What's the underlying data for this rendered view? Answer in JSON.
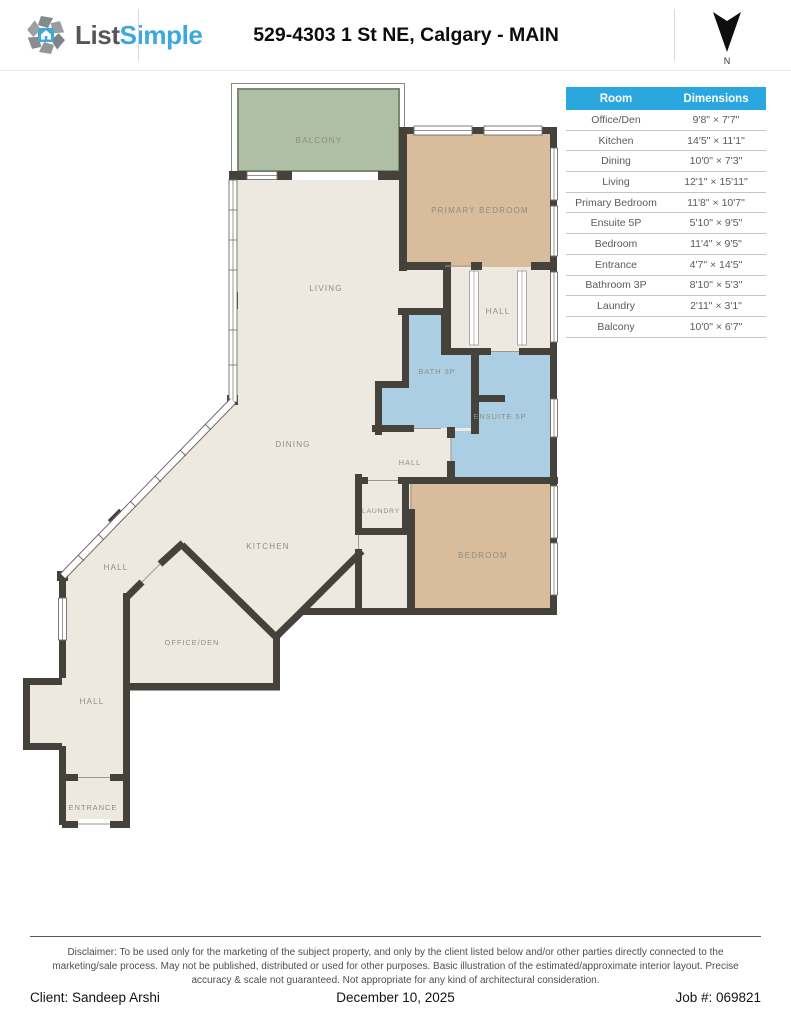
{
  "header": {
    "brand_list": "List",
    "brand_simple": "Simple",
    "title": "529-4303 1 St NE, Calgary - MAIN",
    "north_label": "N"
  },
  "colors": {
    "table_header": "#2aa7df",
    "brand_blue": "#3ba8de",
    "wall": "#45423c",
    "floor_cream": "#ede9e0",
    "room_tan": "#d8bc9b",
    "room_blue": "#abcee2",
    "balcony_green": "#aebfa6",
    "label_gray": "#8f8d85"
  },
  "table": {
    "columns": [
      "Room",
      "Dimensions"
    ],
    "rows": [
      [
        "Office/Den",
        "9'8\" × 7'7\""
      ],
      [
        "Kitchen",
        "14'5\" × 11'1\""
      ],
      [
        "Dining",
        "10'0\" × 7'3\""
      ],
      [
        "Living",
        "12'1\" × 15'11\""
      ],
      [
        "Primary Bedroom",
        "11'8\" × 10'7\""
      ],
      [
        "Ensuite 5P",
        "5'10\" × 9'5\""
      ],
      [
        "Bedroom",
        "11'4\" × 9'5\""
      ],
      [
        "Entrance",
        "4'7\" × 14'5\""
      ],
      [
        "Bathroom 3P",
        "8'10\" × 5'3\""
      ],
      [
        "Laundry",
        "2'11\" × 3'1\""
      ],
      [
        "Balcony",
        "10'0\" × 6'7\""
      ]
    ]
  },
  "plan": {
    "labels": {
      "balcony": "BALCONY",
      "primary_bedroom": "PRIMARY BEDROOM",
      "living": "LIVING",
      "hall_upper": "HALL",
      "bath": "BATH 3P",
      "ensuite": "ENSUITE 5P",
      "dining": "DINING",
      "hall_middle": "HALL",
      "laundry": "LAUNDRY",
      "kitchen": "KITCHEN",
      "bedroom": "BEDROOM",
      "hall_diagonal": "HALL",
      "office_den": "OFFICE/DEN",
      "hall_lower": "HALL",
      "entrance": "ENTRANCE"
    }
  },
  "footer": {
    "disclaimer": "Disclaimer: To be used only for the marketing of the subject property, and only by the client listed below and/or other parties directly connected to the marketing/sale process. May not be published, distributed or used for other purposes. Basic illustration of the estimated/approximate interior layout. Precise accuracy & scale not guaranteed. Not appropriate for any kind of architectural consideration.",
    "client": "Client: Sandeep Arshi",
    "date": "December 10, 2025",
    "job": "Job #: 069821"
  }
}
